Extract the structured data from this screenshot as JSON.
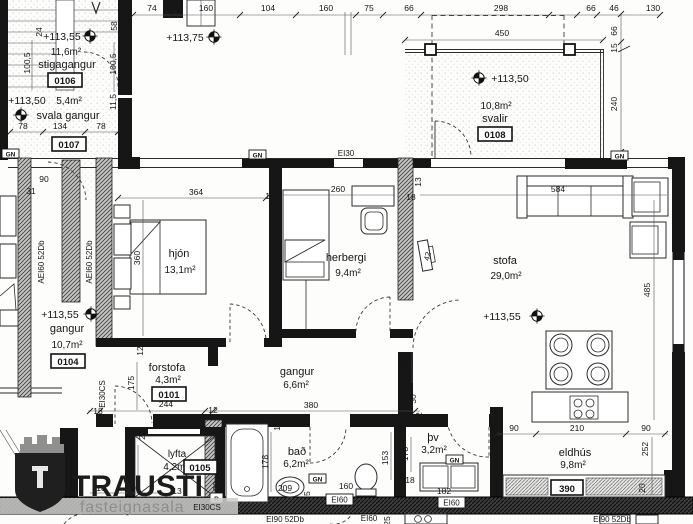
{
  "logo": {
    "name": "TRAUSTI",
    "subtitle": "fasteignasala"
  },
  "rooms": {
    "st": {
      "elev": "+113,55",
      "area": "11,6m²",
      "name": "stigagangur",
      "num": "0106"
    },
    "sg": {
      "elev": "+113,50",
      "area": "5,4m²",
      "name": "svala gangur",
      "num": "0107"
    },
    "sv": {
      "elev": "+113,50",
      "area": "10,8m²",
      "name": "svalir",
      "num": "0108"
    },
    "hj": {
      "name": "hjón",
      "area": "13,1m²"
    },
    "hb": {
      "name": "herbergi",
      "area": "9,4m²"
    },
    "sf": {
      "elev": "+113,55",
      "name": "stofa",
      "area": "29,0m²"
    },
    "g4": {
      "elev": "+113,55",
      "name": "gangur",
      "area": "10,7m²",
      "num": "0104"
    },
    "fs": {
      "name": "forstofa",
      "area": "4,3m²",
      "num": "0101"
    },
    "gm": {
      "name": "gangur",
      "area": "6,6m²"
    },
    "ba": {
      "name": "bað",
      "area": "6,2m²"
    },
    "tv": {
      "name": "þv",
      "area": "3,2m²"
    },
    "ek": {
      "name": "eldhús",
      "area": "9,8m²"
    },
    "ly": {
      "name": "lyfta",
      "area": "4,2m²",
      "num": "0105"
    }
  },
  "el": {
    "e75": "+113,75"
  },
  "wl": {
    "gn": "GN",
    "ei30": "EI30",
    "aei60": "AEI60 52Db",
    "ei30cs": "EI30CS",
    "ei60": "EI60",
    "ei90": "EI90 52Db",
    "r": "R"
  },
  "d": {
    "74": "74",
    "160": "160",
    "104": "104",
    "75": "75",
    "66": "66",
    "298": "298",
    "46": "46",
    "130": "130",
    "450": "450",
    "15": "15",
    "240": "240",
    "100_5": "100,5",
    "24": "24",
    "58": "58",
    "11_5": "11,5",
    "78": "78",
    "134": "134",
    "31": "31",
    "90": "90",
    "364": "364",
    "360": "360",
    "13": "13",
    "18": "18",
    "12": "12",
    "260": "260",
    "584": "584",
    "485": "485",
    "42": "42",
    "380": "380",
    "120": "120",
    "30": "30",
    "244": "244",
    "175": "175",
    "178": "178",
    "209": "209",
    "25": "25",
    "153": "153",
    "182": "182",
    "210": "210",
    "252": "252",
    "20": "20",
    "390": "390",
    "170": "170"
  }
}
